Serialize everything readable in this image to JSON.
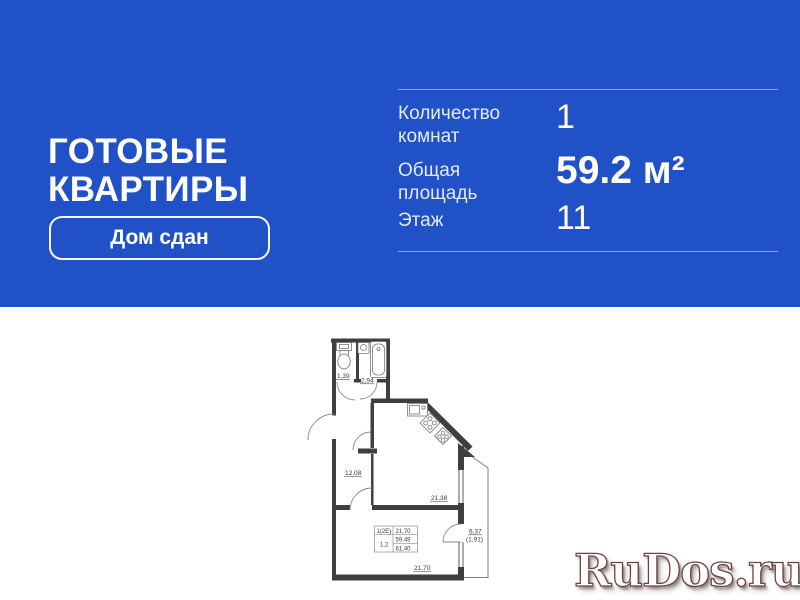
{
  "banner": {
    "bg_color": "#2151c6",
    "title_line1": "ГОТОВЫЕ",
    "title_line2": "КВАРТИРЫ",
    "badge_label": "Дом сдан",
    "stats": {
      "rooms_label_1": "Количество",
      "rooms_label_2": "комнат",
      "rooms_value": "1",
      "area_label_1": "Общая",
      "area_label_2": "площадь",
      "area_value": "59.2 м²",
      "floor_label": "Этаж",
      "floor_value": "11"
    }
  },
  "floorplan": {
    "wc_area": "1,39",
    "bath_area": "2,94",
    "hall_area": "12,08",
    "kitchen_living_area": "21,38",
    "room_area": "21,70",
    "balcony_area": "6,37",
    "balcony_reduced": "(1,91)",
    "table": {
      "r0c0": "1(2Е)",
      "r0c1": "21,70",
      "r1c1": "59,49",
      "r2c0": "1.2",
      "r2c1": "61,40"
    }
  },
  "watermark": {
    "text": "RuDos.ru",
    "face_color": "#ffffff",
    "outline_color": "#6e4242"
  }
}
